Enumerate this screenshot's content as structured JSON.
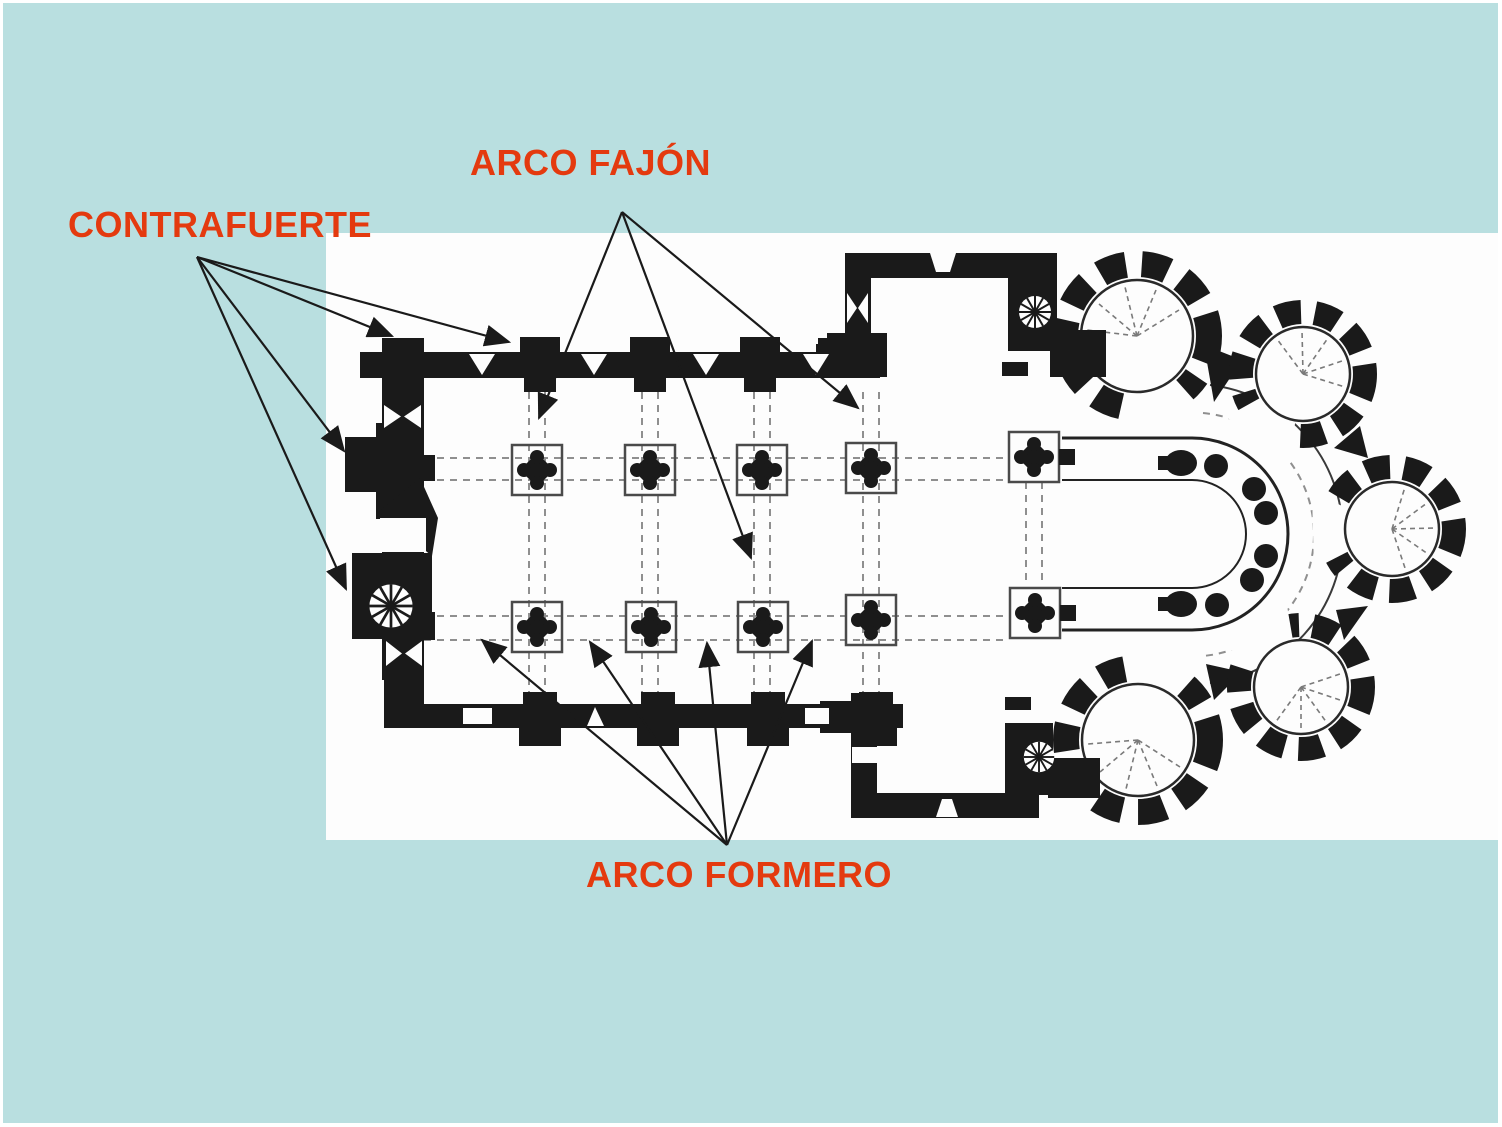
{
  "colors": {
    "bg": "#b9dfe0",
    "panel": "#fdfdfd",
    "ink": "#1a1a1a",
    "label": "#e43a0f",
    "dash": "#8f8f8f"
  },
  "labels": {
    "contrafuerte": "CONTRAFUERTE",
    "arco_fajon": "ARCO FAJÓN",
    "arco_formero": "ARCO FORMERO"
  }
}
